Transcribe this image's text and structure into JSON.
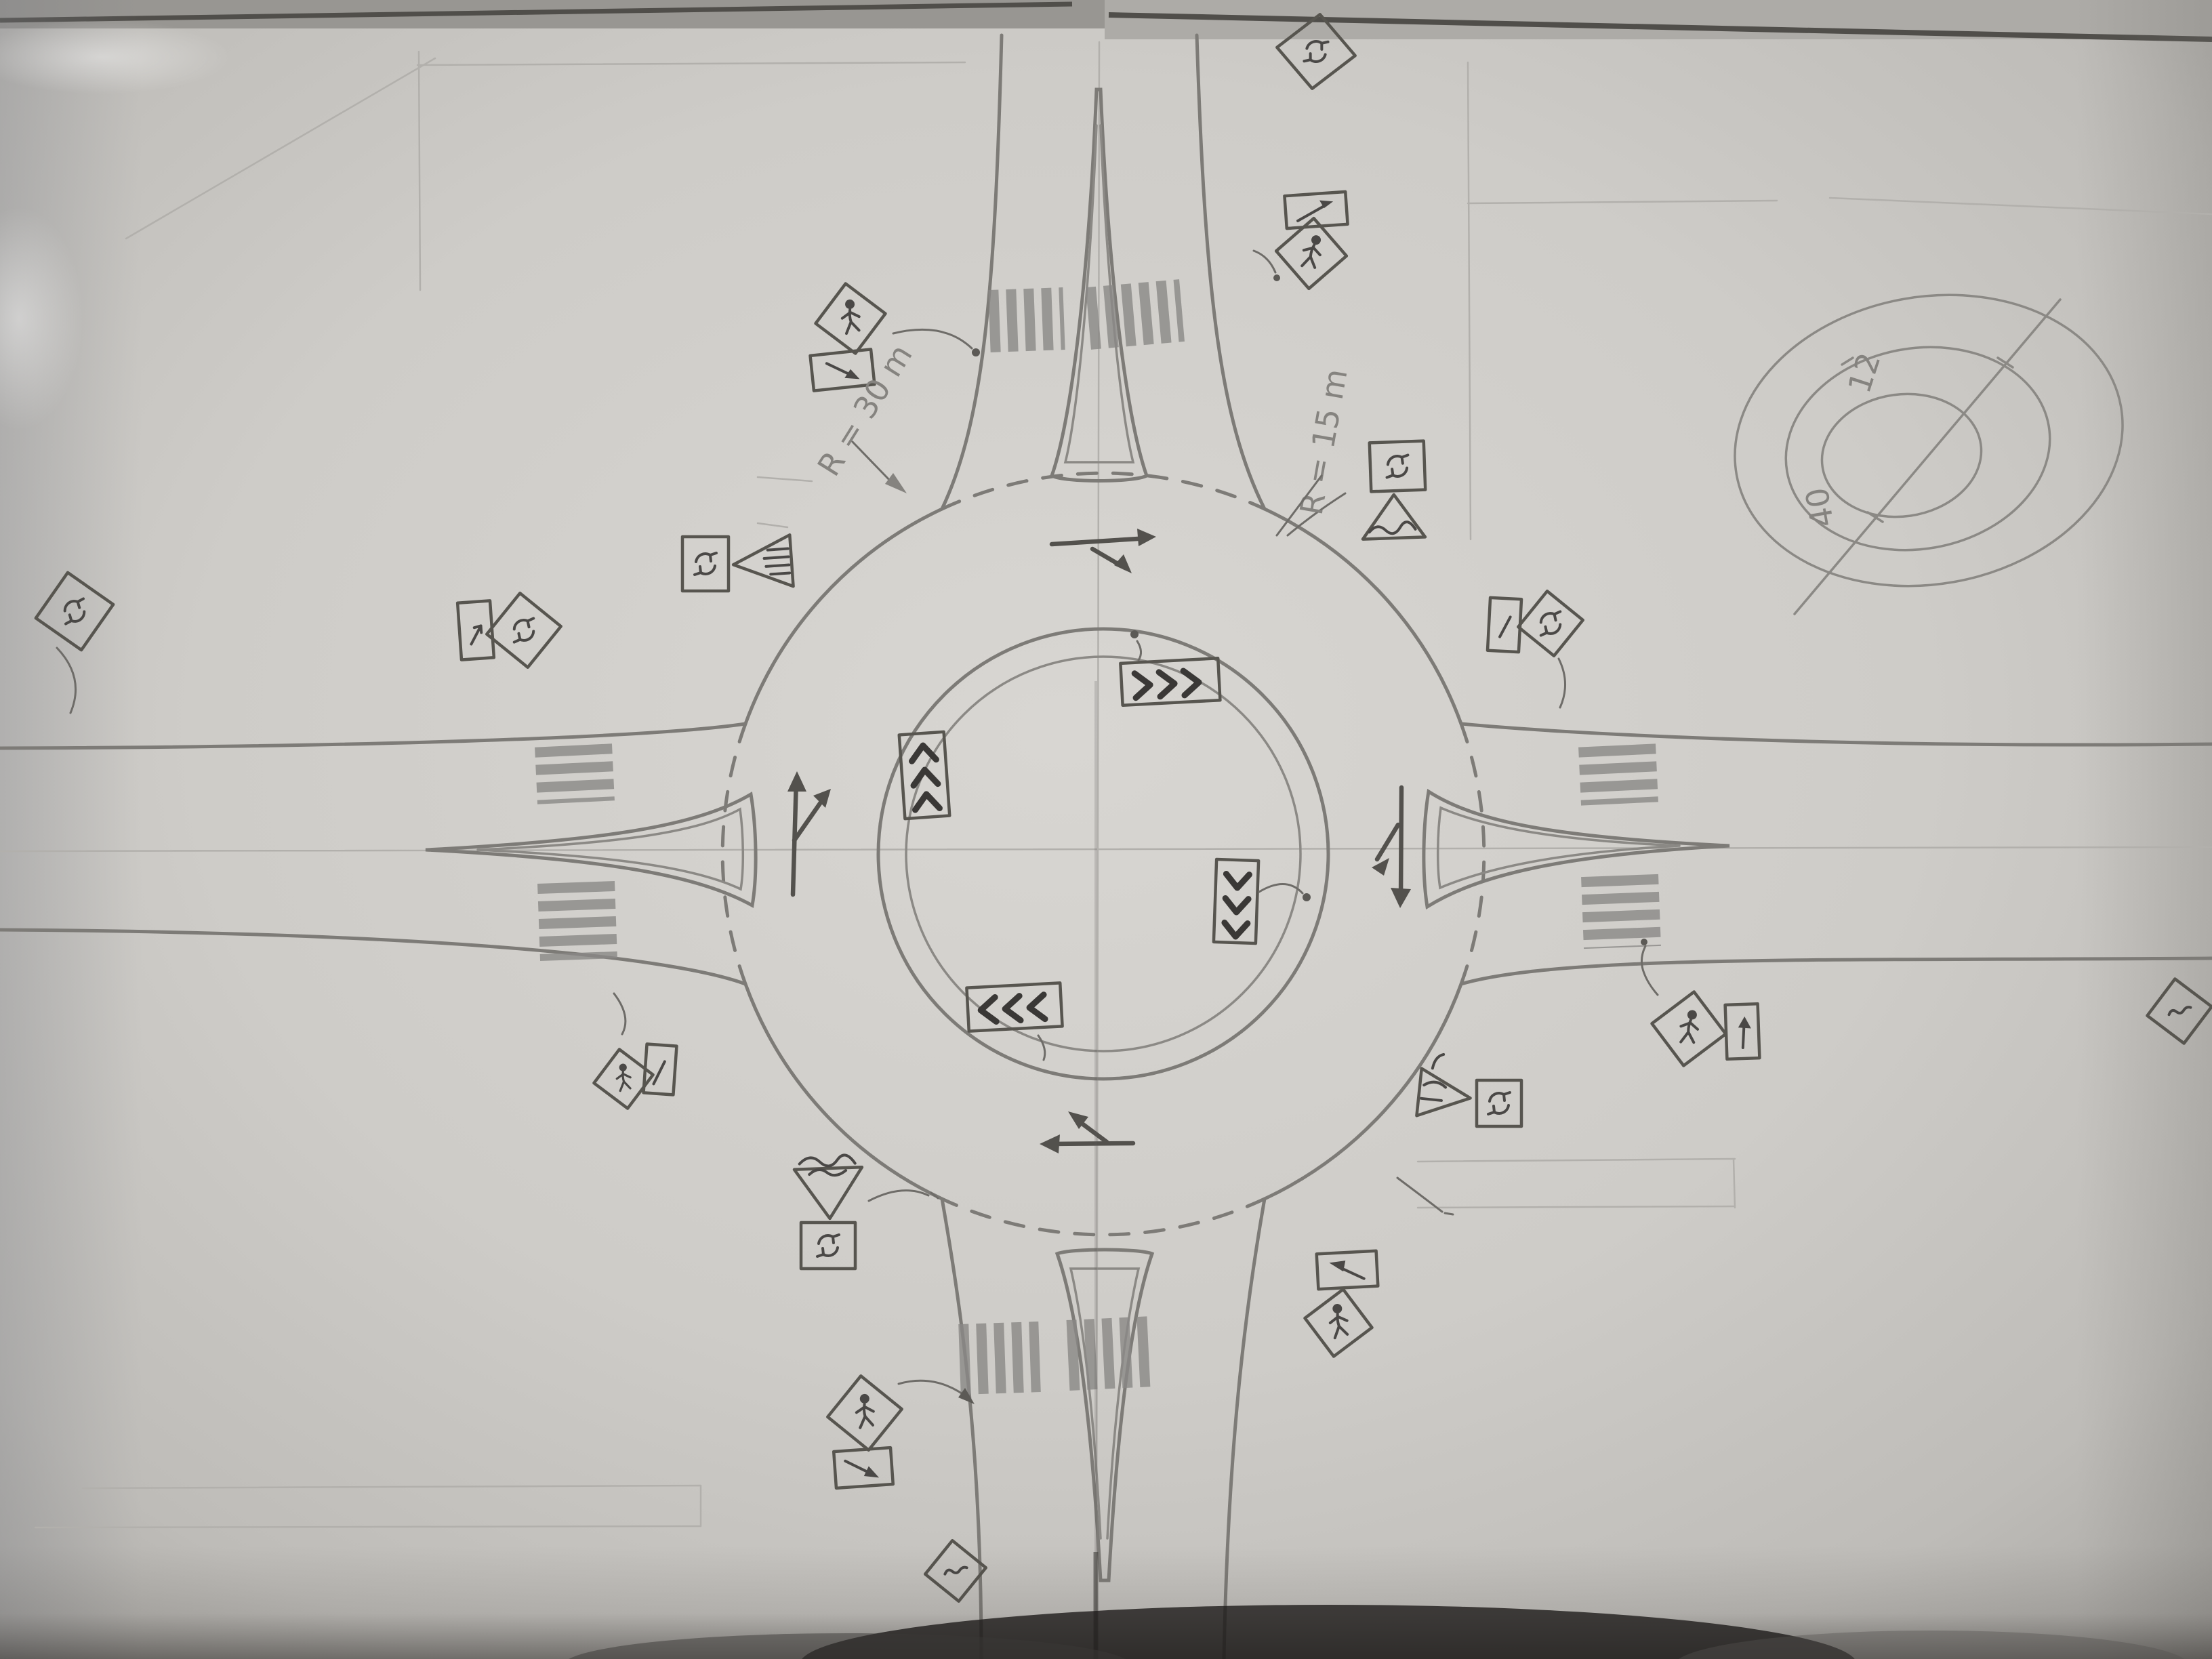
{
  "meta": {
    "title": "Hand-drawn roundabout intersection plan sketch (pencil on paper, photographed)",
    "palette": {
      "paper": "#cfcdc9",
      "paper_edge": "#a7a5a1",
      "pencil": "#7d7b77",
      "pencil_dark": "#4a4846",
      "pencil_faint": "#b2b0ac",
      "table_shadow": "#1e1c1a"
    }
  },
  "annotations": {
    "radius_west": "R = 30 m",
    "radius_east": "R = 15 m",
    "detail_inner_diameter": "12",
    "detail_outer_diameter": "40"
  },
  "detail_sketch": {
    "description": "Top-right corner detail: three concentric ellipses of the central island with a diagonal diameter line",
    "inner_value": "12",
    "outer_value": "40"
  },
  "roundabout": {
    "legs": [
      "north",
      "east",
      "south",
      "west"
    ],
    "features": [
      "central island with inner apron circle",
      "circulating roadway",
      "teardrop splitter islands on all four legs",
      "zebra crosswalks on both sides of each splitter island",
      "dashed yield lines across all four entries",
      "chevron pavement marking boxes inside circulating lane",
      "circulating flow arrows at each entry"
    ],
    "construction_lines": [
      "horizontal centerline",
      "vertical centerline",
      "corner setting-out lines"
    ]
  },
  "markings": {
    "chevron_boxes": [
      {
        "position": "north-inner",
        "direction": "right"
      },
      {
        "position": "west-inner",
        "direction": "up"
      },
      {
        "position": "east-inner",
        "direction": "down"
      },
      {
        "position": "south-inner",
        "direction": "left"
      }
    ],
    "flow_arrows": [
      {
        "position": "top-circulating",
        "direction": "right with merge branch"
      },
      {
        "position": "west-entry",
        "direction": "up with right branch"
      },
      {
        "position": "east-entry",
        "direction": "down with left branch"
      },
      {
        "position": "south-circulating",
        "direction": "left with up-left branch"
      }
    ],
    "crosswalk_legs": [
      "north",
      "east",
      "south",
      "west"
    ]
  },
  "signs": [
    {
      "id": "top-edge-diamond",
      "shape": "diamond",
      "symbol": "roundabout-arrows",
      "location": "north leg, paper top edge"
    },
    {
      "id": "north-right-arrow-board",
      "shape": "rectangle",
      "symbol": "diagonal-arrow",
      "location": "north leg, right side"
    },
    {
      "id": "north-right-pedestrian",
      "shape": "diamond",
      "symbol": "pedestrian",
      "location": "north leg, right side"
    },
    {
      "id": "north-left-pedestrian",
      "shape": "diamond",
      "symbol": "pedestrian",
      "location": "north leg, left side"
    },
    {
      "id": "north-left-arrow-board",
      "shape": "rectangle",
      "symbol": "diagonal-arrow",
      "location": "north leg, left side"
    },
    {
      "id": "west-entry-roundabout",
      "shape": "square",
      "symbol": "roundabout-arrows",
      "location": "west entry splitter island"
    },
    {
      "id": "west-entry-yield",
      "shape": "triangle-left",
      "symbol": "hatch-lines",
      "location": "west entry splitter island"
    },
    {
      "id": "west-arrow-board",
      "shape": "vertical-rectangle",
      "symbol": "small-arrow",
      "location": "west approach"
    },
    {
      "id": "west-roundabout-ahead",
      "shape": "diamond",
      "symbol": "roundabout-arrows",
      "location": "west approach"
    },
    {
      "id": "west-far-roundabout-ahead",
      "shape": "diamond",
      "symbol": "roundabout-arrows",
      "location": "far west, paper left edge"
    },
    {
      "id": "southwest-pedestrian",
      "shape": "diamond",
      "symbol": "pedestrian",
      "location": "southwest quadrant"
    },
    {
      "id": "southwest-arrow-board",
      "shape": "vertical-rectangle",
      "symbol": "small-arrow",
      "location": "southwest quadrant"
    },
    {
      "id": "south-left-yield",
      "shape": "inverted-triangle",
      "symbol": "scribbled-legend",
      "location": "south entry, left"
    },
    {
      "id": "south-left-roundabout",
      "shape": "square",
      "symbol": "roundabout-arrows",
      "location": "south entry, left"
    },
    {
      "id": "south-left-pedestrian",
      "shape": "diamond",
      "symbol": "pedestrian",
      "location": "south leg, left side"
    },
    {
      "id": "south-left-arrow-board",
      "shape": "rectangle",
      "symbol": "diagonal-arrow",
      "location": "south leg, left side"
    },
    {
      "id": "south-edge-warning",
      "shape": "diamond",
      "symbol": "scribble",
      "location": "south leg, paper bottom edge"
    },
    {
      "id": "south-right-arrow-board",
      "shape": "rectangle",
      "symbol": "bold-up-left-arrow",
      "location": "south leg, right side"
    },
    {
      "id": "south-right-pedestrian",
      "shape": "diamond",
      "symbol": "pedestrian",
      "location": "south leg, right side"
    },
    {
      "id": "southeast-yield",
      "shape": "triangle-right",
      "symbol": "scribble",
      "location": "east entry, south side"
    },
    {
      "id": "southeast-roundabout",
      "shape": "square",
      "symbol": "roundabout-arrows",
      "location": "east entry, south side"
    },
    {
      "id": "east-arrow-board",
      "shape": "vertical-rectangle",
      "symbol": "small-arrow",
      "location": "east approach, north side"
    },
    {
      "id": "east-roundabout-ahead",
      "shape": "diamond",
      "symbol": "roundabout-arrows",
      "location": "east approach, north side"
    },
    {
      "id": "east-crosswalk-pedestrian",
      "shape": "diamond",
      "symbol": "pedestrian",
      "location": "east leg at crosswalk"
    },
    {
      "id": "east-crosswalk-arrow-board",
      "shape": "vertical-rectangle",
      "symbol": "up-arrow",
      "location": "east leg at crosswalk"
    },
    {
      "id": "east-far-warning",
      "shape": "diamond",
      "symbol": "scribble",
      "location": "far east, paper right edge"
    },
    {
      "id": "east-top-roundabout",
      "shape": "square",
      "symbol": "roundabout-arrows",
      "location": "northeast quadrant near R=15 note"
    },
    {
      "id": "east-top-yield",
      "shape": "triangle",
      "symbol": "scribbled-word",
      "location": "northeast quadrant near R=15 note"
    }
  ]
}
